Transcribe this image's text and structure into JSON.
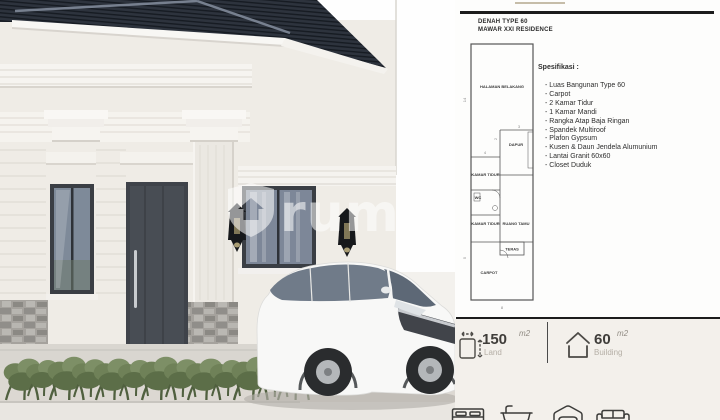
{
  "colors": {
    "roof": "#2d333d",
    "wall": "#efece6",
    "joinery": "#3f434a",
    "plan_line": "#555555",
    "rule": "#1c1c1c",
    "shrub_green": "#6f8158",
    "label_gray": "#b5afa6",
    "panel_bg_lower": "#f3f0eb"
  },
  "scene": {
    "watermark_text": "rumah",
    "icons": [
      "shield-house-icon",
      "wall-lantern-icon",
      "wall-lantern-icon"
    ]
  },
  "panel": {
    "title_line1": "DENAH TYPE 60",
    "title_line2": "MAWAR XXI RESIDENCE",
    "floorplan": {
      "rooms": [
        {
          "label": "HALAMAN BELAKANG"
        },
        {
          "label": "DAPUR"
        },
        {
          "label": "KAMAR TIDUR"
        },
        {
          "label": "WC"
        },
        {
          "label": "KAMAR TIDUR"
        },
        {
          "label": "RUANG TAMU"
        },
        {
          "label": "TERAS"
        },
        {
          "label": "CARPOT"
        }
      ],
      "dims": [
        "14",
        "4",
        "3",
        "2",
        "5",
        "8"
      ]
    },
    "specs": {
      "heading": "Spesifikasi :",
      "items": [
        "- Luas Bangunan Type 60",
        "- Carpot",
        "- 2 Kamar Tidur",
        "- 1 Kamar Mandi",
        "- Rangka Atap Baja Ringan",
        "- Spandek Multiroof",
        "- Plafon Gypsum",
        "- Kusen & Daun Jendela Alumunium",
        "- Lantai Granit 60x60",
        "- Closet Duduk"
      ]
    },
    "land": {
      "value": "150",
      "unit": "m2",
      "label": "Land"
    },
    "building": {
      "value": "60",
      "unit": "m2",
      "label": "Building"
    },
    "footer_icons": [
      "bed-icon",
      "bathtub-icon",
      "car-garage-icon",
      "sofa-icon"
    ]
  }
}
